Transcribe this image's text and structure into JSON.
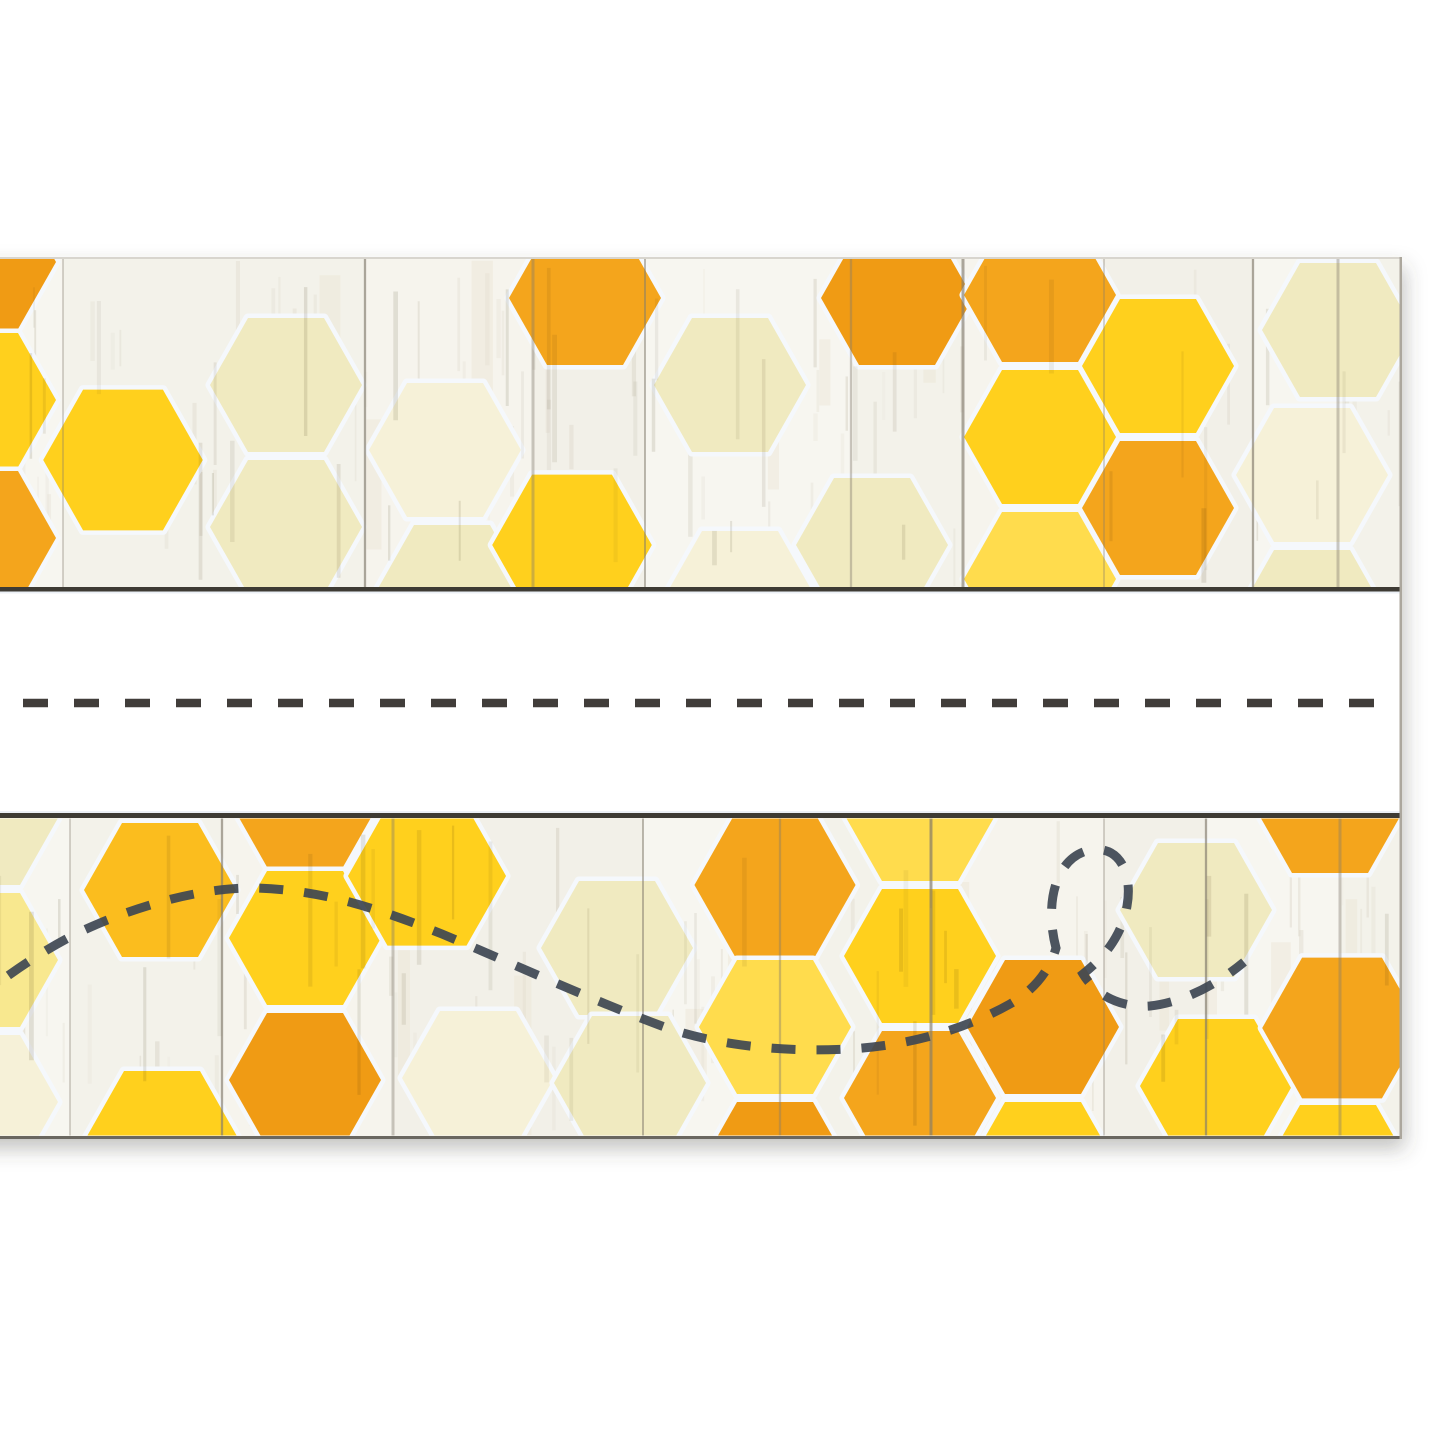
{
  "meta": {
    "description": "Product photo of a honeycomb-pattern student name plate on whitewashed shiplap wood",
    "background": "#FFFFFF"
  },
  "palette": {
    "gold": "#F4A51C",
    "gold_deep": "#F09B14",
    "yellow_gold": "#FBBD1E",
    "yellow": "#FFD01D",
    "yellow_light": "#FFDC4D",
    "yellow_pale": "#F8E88F",
    "cream": "#F0EAC0",
    "cream_light": "#F6F1D8"
  },
  "wood": {
    "base": "#F7F5F0",
    "plank_tints": [
      "#F8F6F1",
      "#F1EEE6",
      "#F5F2EB",
      "#EFEBE2"
    ],
    "streak_colors": [
      "#DAD4C6",
      "#CBC5B5",
      "#E4DFD3"
    ],
    "warm_streak": "#EAE2CF",
    "seam_color": "#837C6E",
    "overlay_streak": "#9A937F",
    "hex_halo": "#F5F8FC"
  },
  "card": {
    "x": -30,
    "y": 257,
    "width": 1432,
    "height": 882,
    "top_edge_color": "#D8D5CE",
    "right_edge_color": "#ACA79D",
    "bottom_edge_color": "#514E46",
    "shadow": {
      "dx": 3,
      "dy": 10,
      "blur": 10,
      "color": "#4A463A",
      "opacity": 0.32
    }
  },
  "hex_size": {
    "width": 152,
    "height": 134
  },
  "separators": {
    "color": "#3E3B34",
    "bars": [
      {
        "y": 587,
        "h": 4.5
      },
      {
        "y": 813,
        "h": 5
      }
    ]
  },
  "writing_strip": {
    "y": 591.5,
    "height": 221.5,
    "fill": "#FFFFFF",
    "line": {
      "y": 703,
      "color": "#413D3A",
      "width": 8.5,
      "dash": [
        25,
        26
      ],
      "x1": -28,
      "x2": 1400
    }
  },
  "top_border": {
    "y": 258,
    "height": 329,
    "seams": [
      63,
      365,
      533,
      645,
      851,
      963,
      1104,
      1253,
      1338
    ],
    "hexes": [
      [
        -20,
        262,
        "gold_deep"
      ],
      [
        -20,
        400,
        "yellow"
      ],
      [
        -20,
        538,
        "gold"
      ],
      [
        123,
        460,
        "yellow",
        1.05
      ],
      [
        286,
        385,
        "cream"
      ],
      [
        286,
        527,
        "cream"
      ],
      [
        445,
        450,
        "cream_light"
      ],
      [
        452,
        592,
        "cream"
      ],
      [
        585,
        298,
        "gold"
      ],
      [
        572,
        545,
        "yellow",
        1.05
      ],
      [
        730,
        385,
        "cream"
      ],
      [
        740,
        598,
        "cream_light"
      ],
      [
        872,
        545,
        "cream"
      ],
      [
        897,
        298,
        "gold_deep"
      ],
      [
        1040,
        295,
        "gold"
      ],
      [
        1040,
        437,
        "yellow"
      ],
      [
        1040,
        579,
        "yellow_light"
      ],
      [
        1158,
        366,
        "yellow"
      ],
      [
        1158,
        508,
        "gold"
      ],
      [
        1338,
        330,
        "cream"
      ],
      [
        1312,
        475,
        "cream_light"
      ],
      [
        1312,
        617,
        "cream"
      ]
    ]
  },
  "bottom_border": {
    "y": 818.5,
    "height": 317,
    "seams": [
      70,
      222,
      393,
      643,
      780,
      931,
      1104,
      1206,
      1340
    ],
    "hexes": [
      [
        -18,
        818,
        "cream"
      ],
      [
        -18,
        960,
        "yellow_pale"
      ],
      [
        -18,
        1102,
        "cream_light"
      ],
      [
        160,
        890,
        "yellow_gold"
      ],
      [
        162,
        1138,
        "yellow"
      ],
      [
        305,
        800,
        "gold"
      ],
      [
        305,
        938,
        "yellow"
      ],
      [
        305,
        1080,
        "gold_deep"
      ],
      [
        427,
        876,
        "yellow",
        1.04
      ],
      [
        478,
        1078,
        "cream_light"
      ],
      [
        617,
        948,
        "cream"
      ],
      [
        630,
        1083,
        "cream"
      ],
      [
        775,
        885,
        "gold",
        1.06
      ],
      [
        775,
        1027,
        "yellow_light"
      ],
      [
        775,
        1169,
        "gold_deep"
      ],
      [
        920,
        814,
        "yellow_light"
      ],
      [
        920,
        956,
        "yellow"
      ],
      [
        920,
        1098,
        "gold"
      ],
      [
        1043,
        1027,
        "gold_deep"
      ],
      [
        1043,
        1169,
        "yellow"
      ],
      [
        1196,
        910,
        "cream"
      ],
      [
        1216,
        1086,
        "yellow"
      ],
      [
        1330,
        806,
        "gold"
      ],
      [
        1342,
        1028,
        "gold",
        1.05
      ],
      [
        1338,
        1172,
        "yellow"
      ]
    ],
    "bee_trail": {
      "path": "M -28 1002 C 12 972 46 948 84 930 C 132 908 196 888 252 888 C 322 889 382 910 442 934 C 516 965 598 1003 670 1029 C 726 1047 788 1052 848 1049 C 906 1046 962 1031 1010 1004 C 1036 989 1050 969 1056 948 C 1045 906 1054 861 1086 851 C 1119 842 1133 873 1127 906 C 1121 941 1098 962 1083 974 C 1096 996 1122 1008 1150 1006 C 1186 1002 1220 982 1244 962",
      "color": "#3E4753",
      "width": 9,
      "dash": [
        24,
        21
      ]
    }
  },
  "texture_seed": 11
}
